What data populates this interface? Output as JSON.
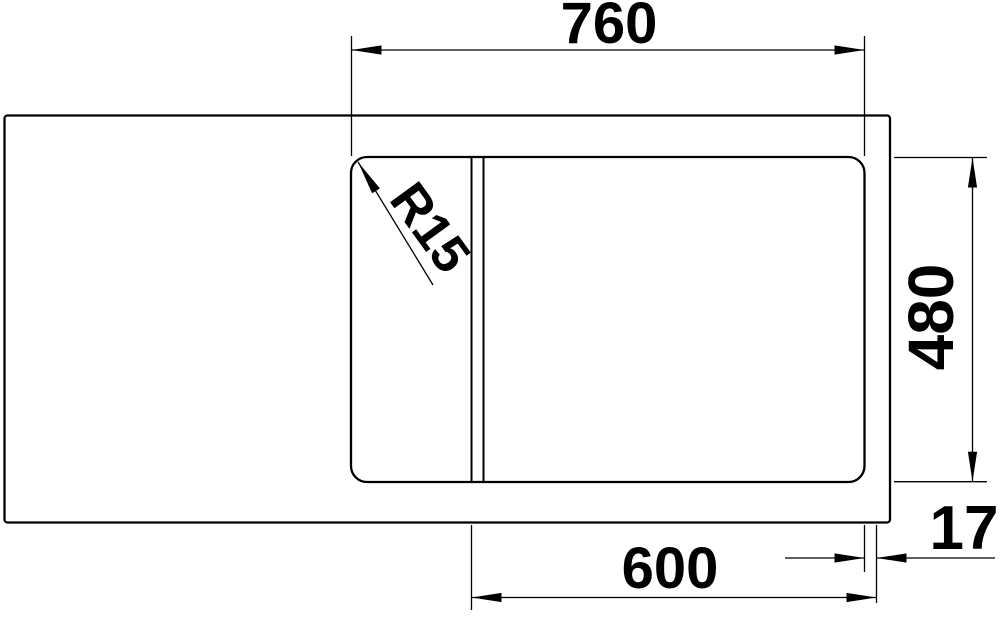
{
  "drawing": {
    "background_color": "#ffffff",
    "line_color": "#000000",
    "dimensions": {
      "top_width": "760",
      "right_height": "480",
      "bottom_width": "600",
      "bottom_right_offset": "17",
      "corner_radius": "R15"
    }
  }
}
